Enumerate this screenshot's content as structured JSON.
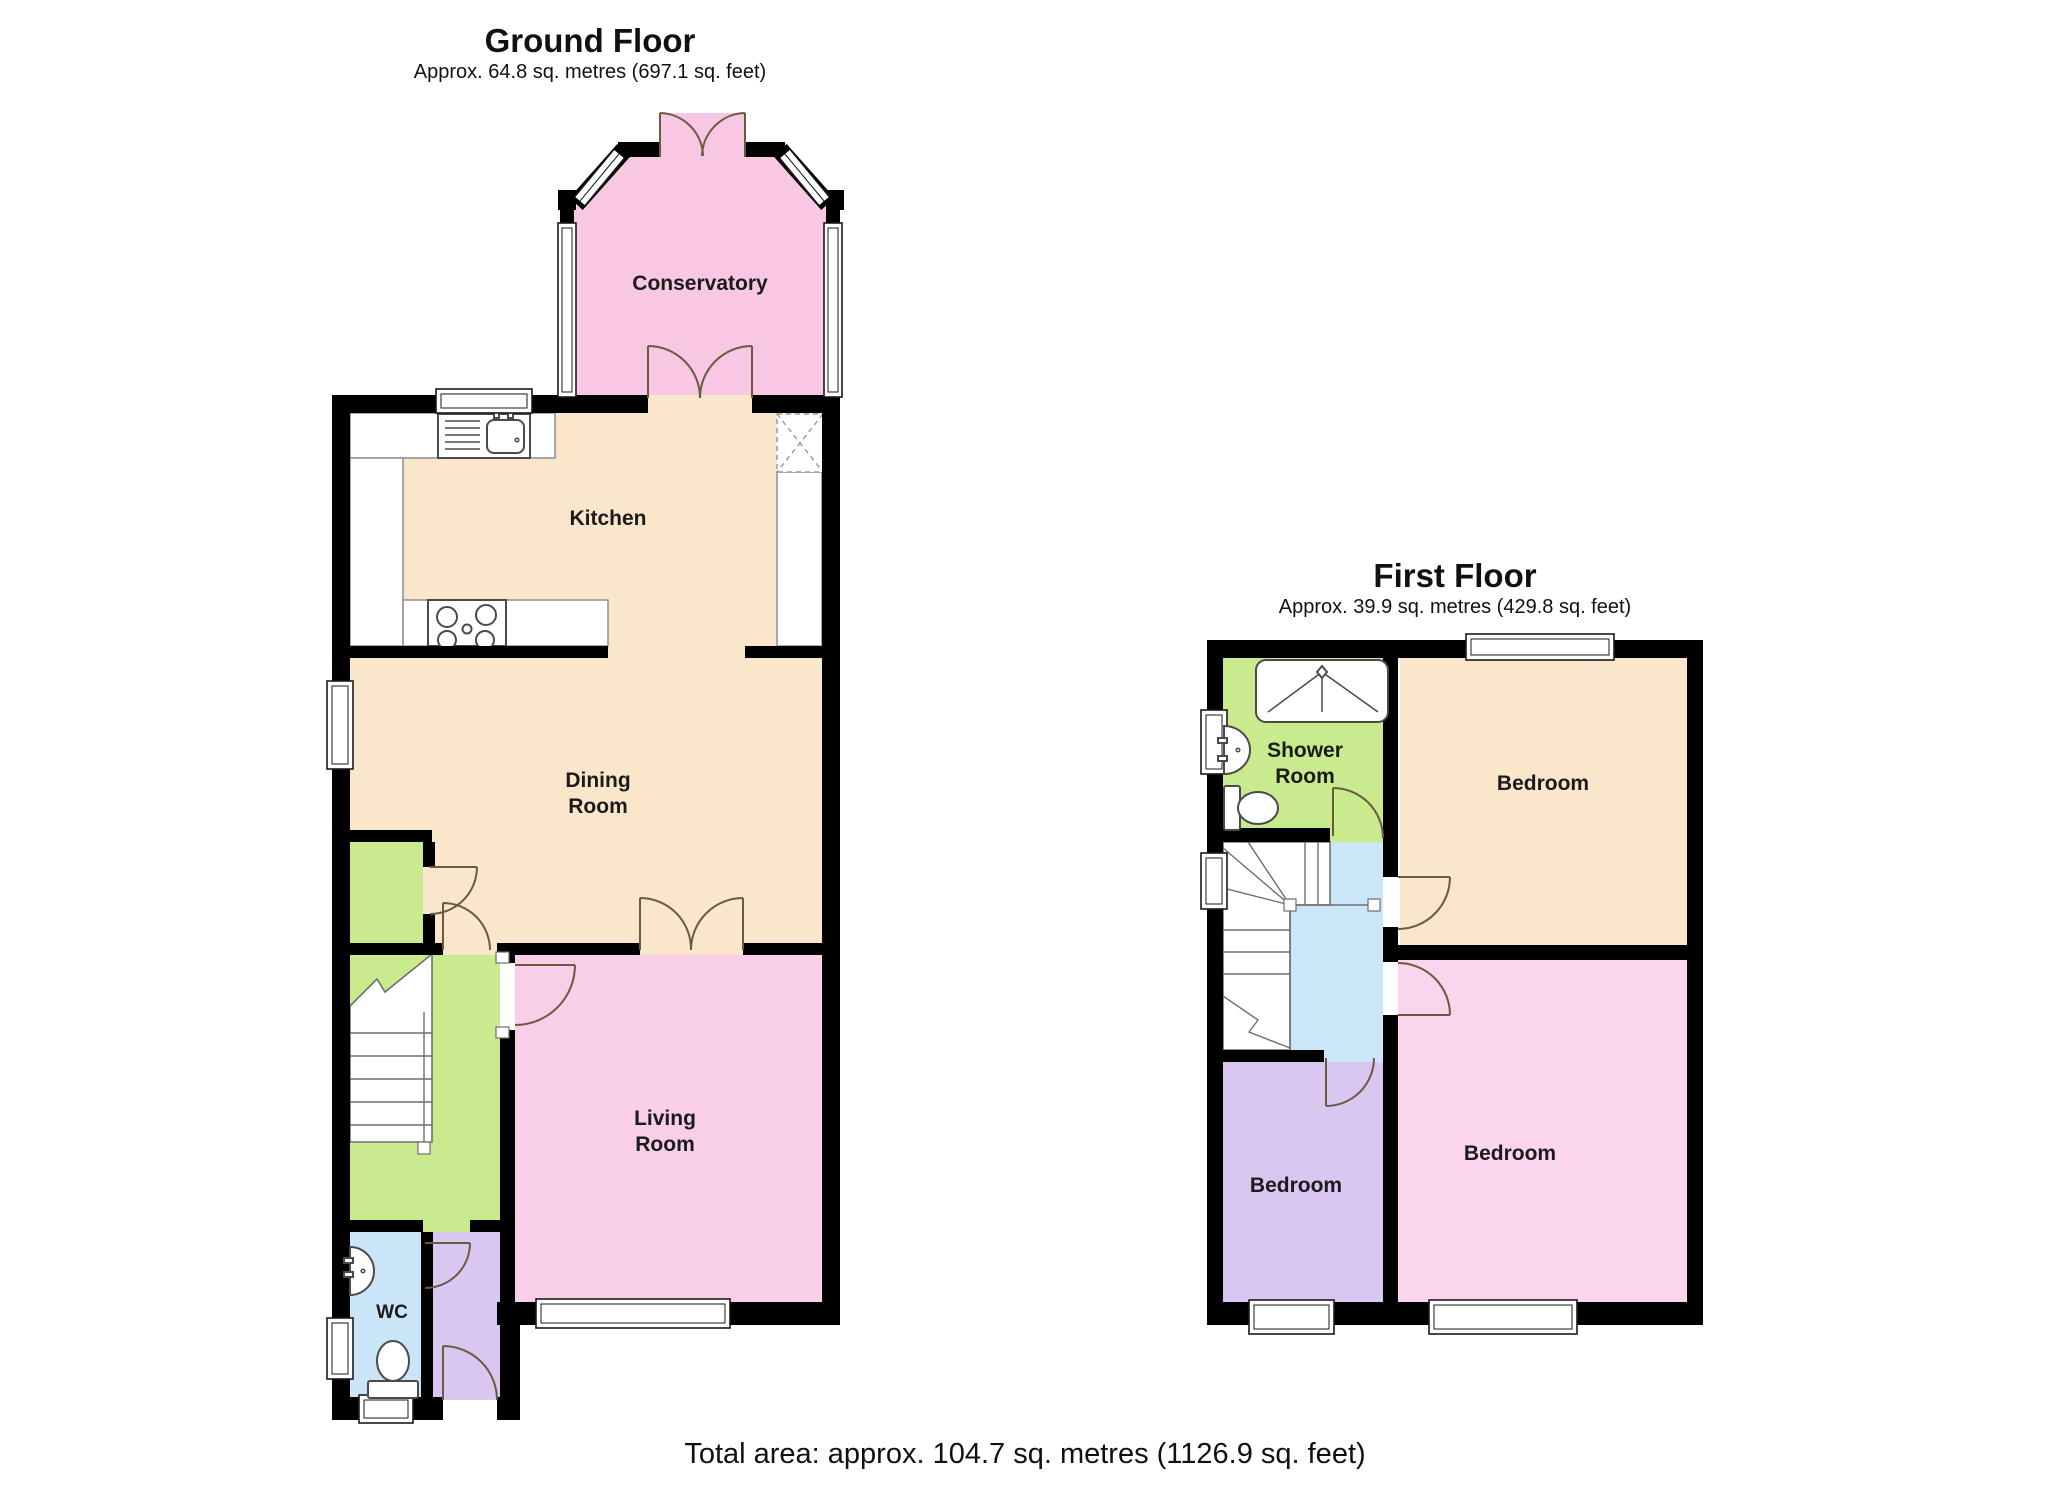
{
  "ground_floor": {
    "title": "Ground Floor",
    "subtitle": "Approx. 64.8 sq. metres (697.1 sq. feet)",
    "rooms": {
      "conservatory": {
        "label": "Conservatory",
        "color": "#f7c7e3"
      },
      "kitchen": {
        "label": "Kitchen",
        "color": "#fae7cb"
      },
      "dining_room": {
        "label_lines": [
          "Dining",
          "Room"
        ],
        "color": "#fae7cb"
      },
      "living_room": {
        "label_lines": [
          "Living",
          "Room"
        ],
        "color": "#f9cee9"
      },
      "wc": {
        "label": "WC",
        "color": "#c9e5f7"
      },
      "hallway": {
        "color": "#c9ea8d"
      },
      "store_cupboard": {
        "color": "#c9ea8d"
      },
      "entrance_hall": {
        "color": "#d9c7f2"
      }
    }
  },
  "first_floor": {
    "title": "First Floor",
    "subtitle": "Approx. 39.9 sq. metres (429.8 sq. feet)",
    "rooms": {
      "shower_room": {
        "label_lines": [
          "Shower",
          "Room"
        ],
        "color": "#c9ea8d"
      },
      "bedroom_front": {
        "label": "Bedroom",
        "color": "#fae7cb"
      },
      "bedroom_small": {
        "label": "Bedroom",
        "color": "#d9c7f2"
      },
      "bedroom_rear": {
        "label": "Bedroom",
        "color": "#fbd4ed"
      },
      "landing": {
        "color": "#cbe6f8"
      }
    }
  },
  "footer": {
    "total_area": "Total area: approx. 104.7 sq. metres (1126.9 sq. feet)"
  },
  "palette": {
    "wall": "#000000",
    "door_swing": "#6b5a3f",
    "fixture_outline": "#4a4a4a"
  }
}
